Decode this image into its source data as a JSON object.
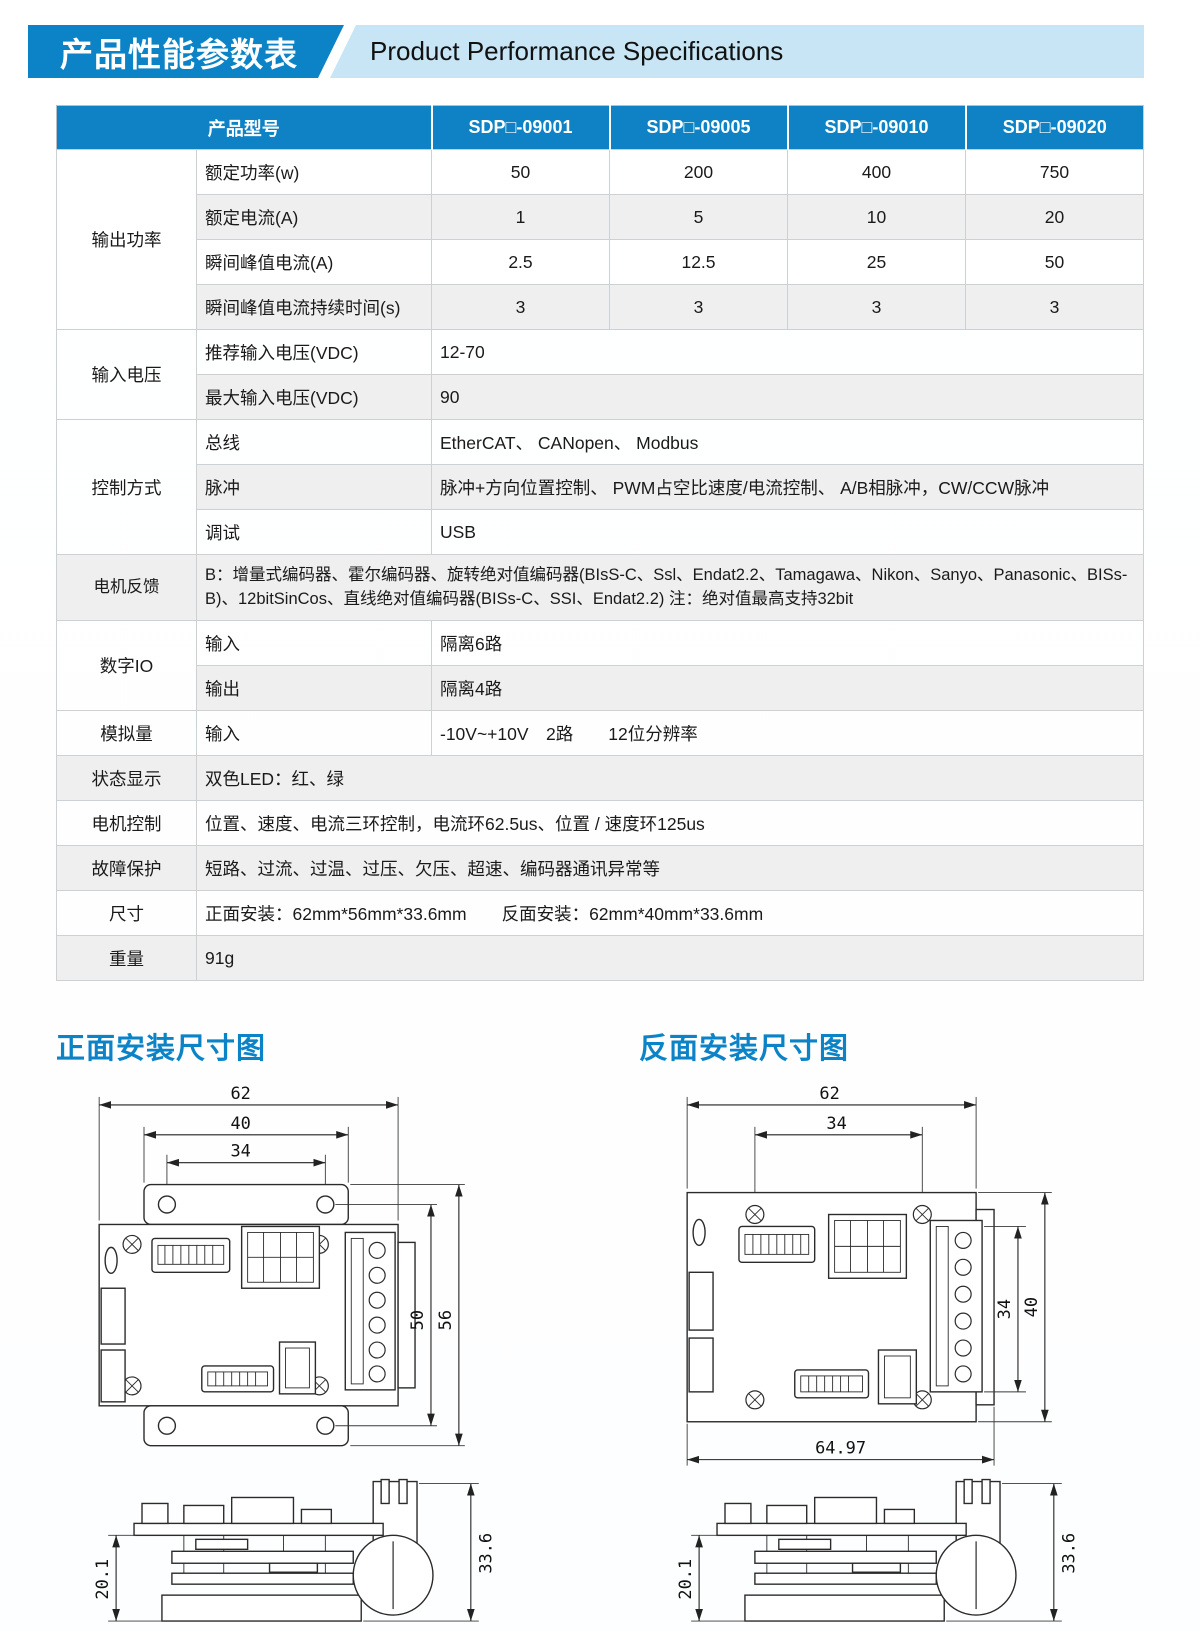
{
  "colors": {
    "accent_blue": "#0c83c6",
    "banner_light_blue": "#c7e5f5",
    "table_header_blue": "#0e82c4",
    "row_stripe": "#efefef"
  },
  "page": {
    "title_cn": "产品性能参数表",
    "title_en": "Product Performance Specifications"
  },
  "spec_table": {
    "model_header": "产品型号",
    "models": [
      "SDP□-09001",
      "SDP□-09005",
      "SDP□-09010",
      "SDP□-09020"
    ],
    "output_power": {
      "group": "输出功率",
      "rows": [
        {
          "label": "额定功率(w)",
          "values": [
            "50",
            "200",
            "400",
            "750"
          ]
        },
        {
          "label": "额定电流(A)",
          "values": [
            "1",
            "5",
            "10",
            "20"
          ]
        },
        {
          "label": "瞬间峰值电流(A)",
          "values": [
            "2.5",
            "12.5",
            "25",
            "50"
          ]
        },
        {
          "label": "瞬间峰值电流持续时间(s)",
          "values": [
            "3",
            "3",
            "3",
            "3"
          ]
        }
      ]
    },
    "input_voltage": {
      "group": "输入电压",
      "rows": [
        {
          "label": "推荐输入电压(VDC)",
          "value": "12-70"
        },
        {
          "label": "最大输入电压(VDC)",
          "value": "90"
        }
      ]
    },
    "control_mode": {
      "group": "控制方式",
      "rows": [
        {
          "label": "总线",
          "value": "EtherCAT、 CANopen、 Modbus"
        },
        {
          "label": "脉冲",
          "value": "脉冲+方向位置控制、 PWM占空比速度/电流控制、 A/B相脉冲，CW/CCW脉冲"
        },
        {
          "label": "调试",
          "value": "USB"
        }
      ]
    },
    "motor_feedback": {
      "label": "电机反馈",
      "value": "B：增量式编码器、霍尔编码器、旋转绝对值编码器(BIsS-C、Ssl、Endat2.2、Tamagawa、Nikon、Sanyo、Panasonic、BISs-B)、12bitSinCos、直线绝对值编码器(BISs-C、SSI、Endat2.2) 注：绝对值最高支持32bit"
    },
    "digital_io": {
      "group": "数字IO",
      "rows": [
        {
          "label": "输入",
          "value": "隔离6路"
        },
        {
          "label": "输出",
          "value": "隔离4路"
        }
      ]
    },
    "analog": {
      "group": "模拟量",
      "rows": [
        {
          "label": "输入",
          "value": "-10V~+10V　2路　　12位分辨率"
        }
      ]
    },
    "status_display": {
      "label": "状态显示",
      "value": "双色LED：红、绿"
    },
    "motor_control": {
      "label": "电机控制",
      "value": "位置、速度、电流三环控制，电流环62.5us、位置 / 速度环125us"
    },
    "fault_protection": {
      "label": "故障保护",
      "value": "短路、过流、过温、过压、欠压、超速、编码器通讯异常等"
    },
    "dimensions": {
      "label": "尺寸",
      "value": "正面安装：62mm*56mm*33.6mm　　反面安装：62mm*40mm*33.6mm"
    },
    "weight": {
      "label": "重量",
      "value": "91g"
    }
  },
  "drawings": {
    "front": {
      "title": "正面安装尺寸图",
      "dims": {
        "outer_width": "62",
        "bracket_width": "40",
        "hole_spacing": "34",
        "hole_height": "50",
        "outer_height": "56"
      },
      "side_dims": {
        "board_height": "20.1",
        "total_height": "33.6"
      }
    },
    "back": {
      "title": "反面安装尺寸图",
      "dims": {
        "outer_width": "62",
        "hole_spacing": "34",
        "inner_height": "34",
        "outer_height": "40",
        "total_width": "64.97"
      },
      "side_dims": {
        "board_height": "20.1",
        "total_height": "33.6"
      }
    }
  }
}
